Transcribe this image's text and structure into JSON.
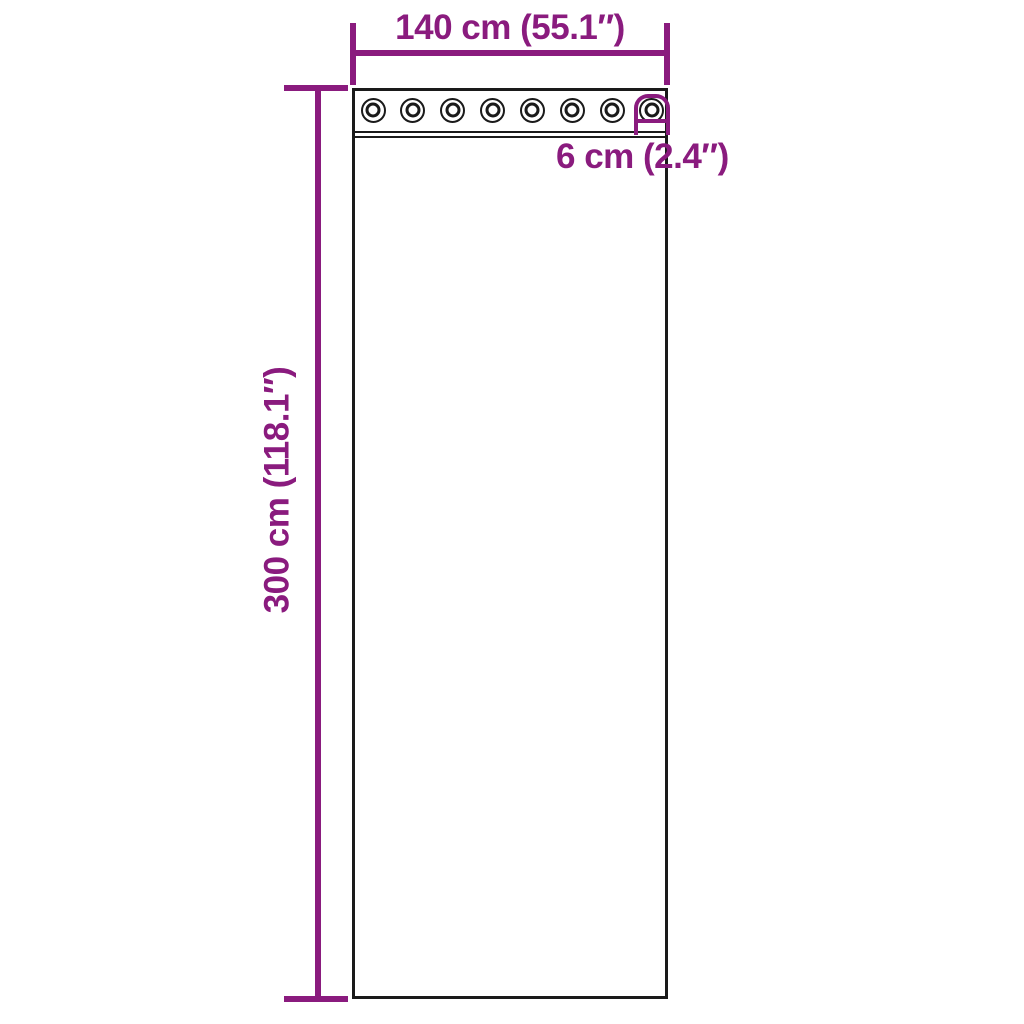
{
  "colors": {
    "accent": "#8A1B7E",
    "outline": "#1A1A1A",
    "background": "#FFFFFF"
  },
  "labels": {
    "width": "140 cm (55.1″)",
    "height": "300 cm (118.1″)",
    "header_height": "6 cm (2.4″)"
  },
  "curtain": {
    "grommet_count": 8
  }
}
